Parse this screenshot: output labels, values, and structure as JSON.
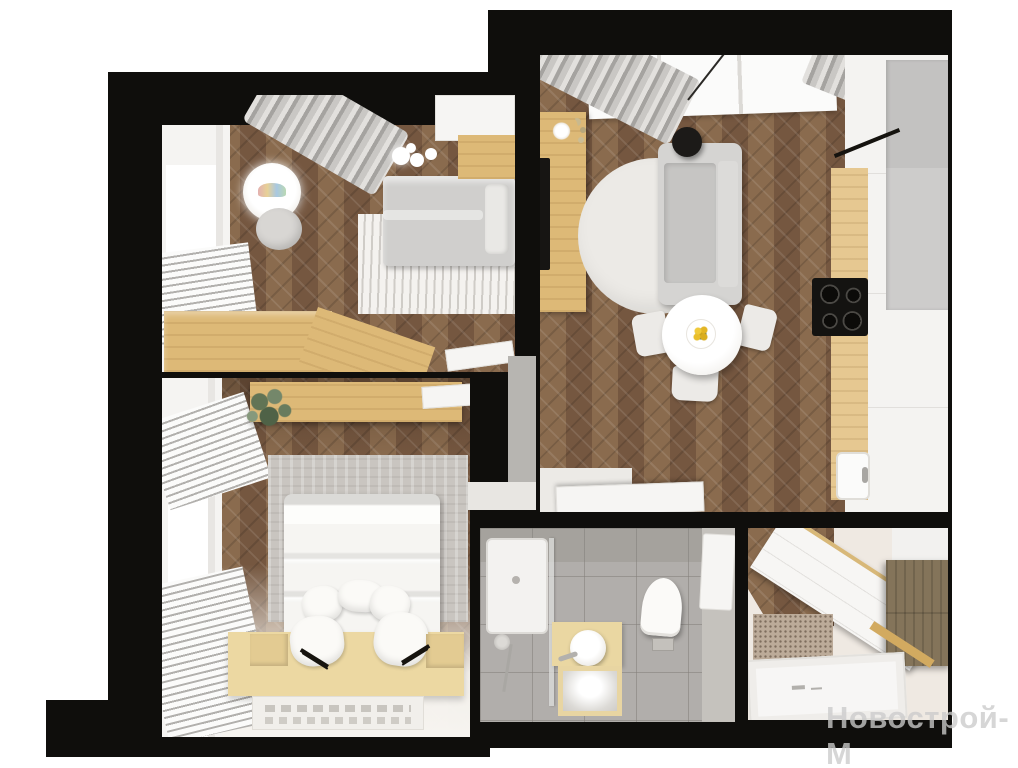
{
  "image": {
    "kind": "3d-apartment-floor-plan-render",
    "width": 1018,
    "height": 768
  },
  "watermark": {
    "text": "Новострой-М",
    "color": "#cbcbcb"
  },
  "palette": {
    "background": "#ffffff",
    "wall": "#0f0e0c",
    "wood_floor": "#7f614a",
    "wood_floor_plank_light": "#8a6b4e",
    "wood_floor_plank_dark": "#755740",
    "light_wood_furniture": "#ddb977",
    "platform_wood": "#ecd8a2",
    "dark_wood_cabinet": "#84745a",
    "bathroom_tile": "#b1aeab",
    "sofa_gray": "#d5d4d2",
    "curtain_gray": "#c9c7c4",
    "rug_white": "#eceae6",
    "flower_yellow": "#e9be2b",
    "plant_green": "#5f7252",
    "toilet_white": "#fbfaf8"
  },
  "rooms": [
    {
      "id": "kids-room",
      "position": "top-left",
      "furniture": [
        "window",
        "sheer-curtain",
        "blinds",
        "glowing-table-lamp",
        "pouf",
        "single-bed",
        "striped-rug",
        "wood-desk",
        "wardrobe",
        "ceiling-light",
        "door"
      ]
    },
    {
      "id": "living-kitchen",
      "position": "top-right",
      "furniture": [
        "window",
        "curtains",
        "tv-console",
        "tv",
        "round-rug",
        "sofa",
        "black-pendant-lamp",
        "dining-table",
        "flower-centerpiece",
        "three-chairs",
        "kitchen-cabinets",
        "tall-gray-cabinet",
        "wood-countertop",
        "cooktop",
        "sink",
        "open-door"
      ]
    },
    {
      "id": "bedroom",
      "position": "bottom-left",
      "furniture": [
        "window",
        "blinds",
        "wall-shelf",
        "plant",
        "headboard-panel",
        "double-bed",
        "five-pillows",
        "wood-platform",
        "two-nightstands",
        "two-reading-lamps",
        "text-rug",
        "door"
      ]
    },
    {
      "id": "bathroom",
      "position": "bottom-middle",
      "furniture": [
        "shower-tray",
        "glass-screen",
        "hand-shower",
        "wood-vanity",
        "round-vessel-sink",
        "faucet",
        "framed-mirror-counter",
        "wall-hung-toilet",
        "floor-drain",
        "door"
      ]
    },
    {
      "id": "hallway",
      "position": "bottom-right",
      "furniture": [
        "white-wardrobe",
        "dark-overhead-cabinet",
        "doormat",
        "entrance-door",
        "gold-trim"
      ]
    }
  ]
}
